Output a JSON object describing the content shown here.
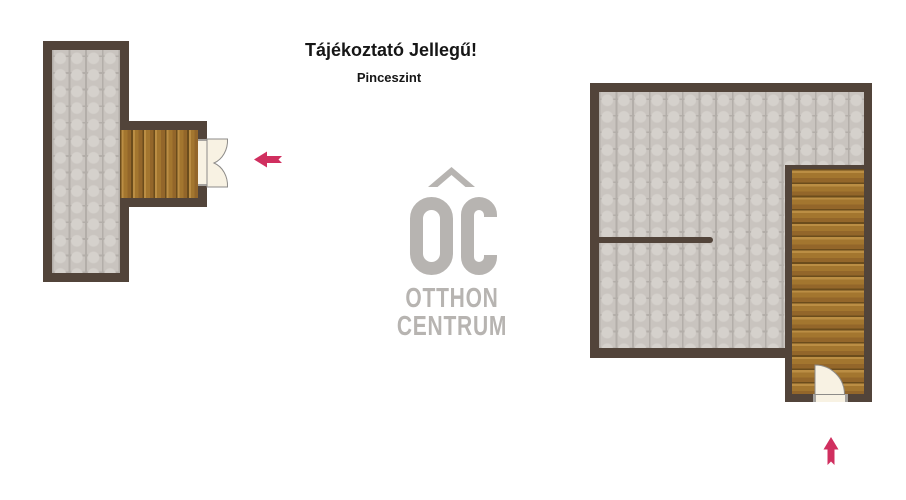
{
  "header": {
    "title": "Tájékoztató Jellegű!",
    "subtitle": "Pinceszint"
  },
  "logo": {
    "monogram": "OC",
    "line1": "OTTHON",
    "line2": "CENTRUM"
  },
  "colors": {
    "wall": "#52443a",
    "floor_base": "#c9c4bf",
    "floor_dot": "#d5d1cc",
    "floor_grid": "#b3aea9",
    "wood": "#a3762f",
    "wood_light": "#bb8e44",
    "wood_line": "#6b4c1c",
    "door": "#f8f2e3",
    "door_outline": "#8d8b88",
    "jamb": "#a5a29e",
    "arrow": "#d02f5f",
    "logo_gray": "#b7b4b1"
  },
  "plans": {
    "left": {
      "rooms": [
        "tiled-basement-room"
      ],
      "features": [
        "wooden-stairs",
        "double-door-east",
        "exit-arrow-left"
      ]
    },
    "right": {
      "rooms": [
        "tiled-basement-room"
      ],
      "features": [
        "partition-wall",
        "wooden-staircase-south",
        "single-door-south",
        "entry-arrow-up"
      ]
    }
  },
  "arrows": [
    {
      "id": "exit-arrow-left",
      "direction": "left"
    },
    {
      "id": "entry-arrow-up",
      "direction": "up"
    }
  ]
}
